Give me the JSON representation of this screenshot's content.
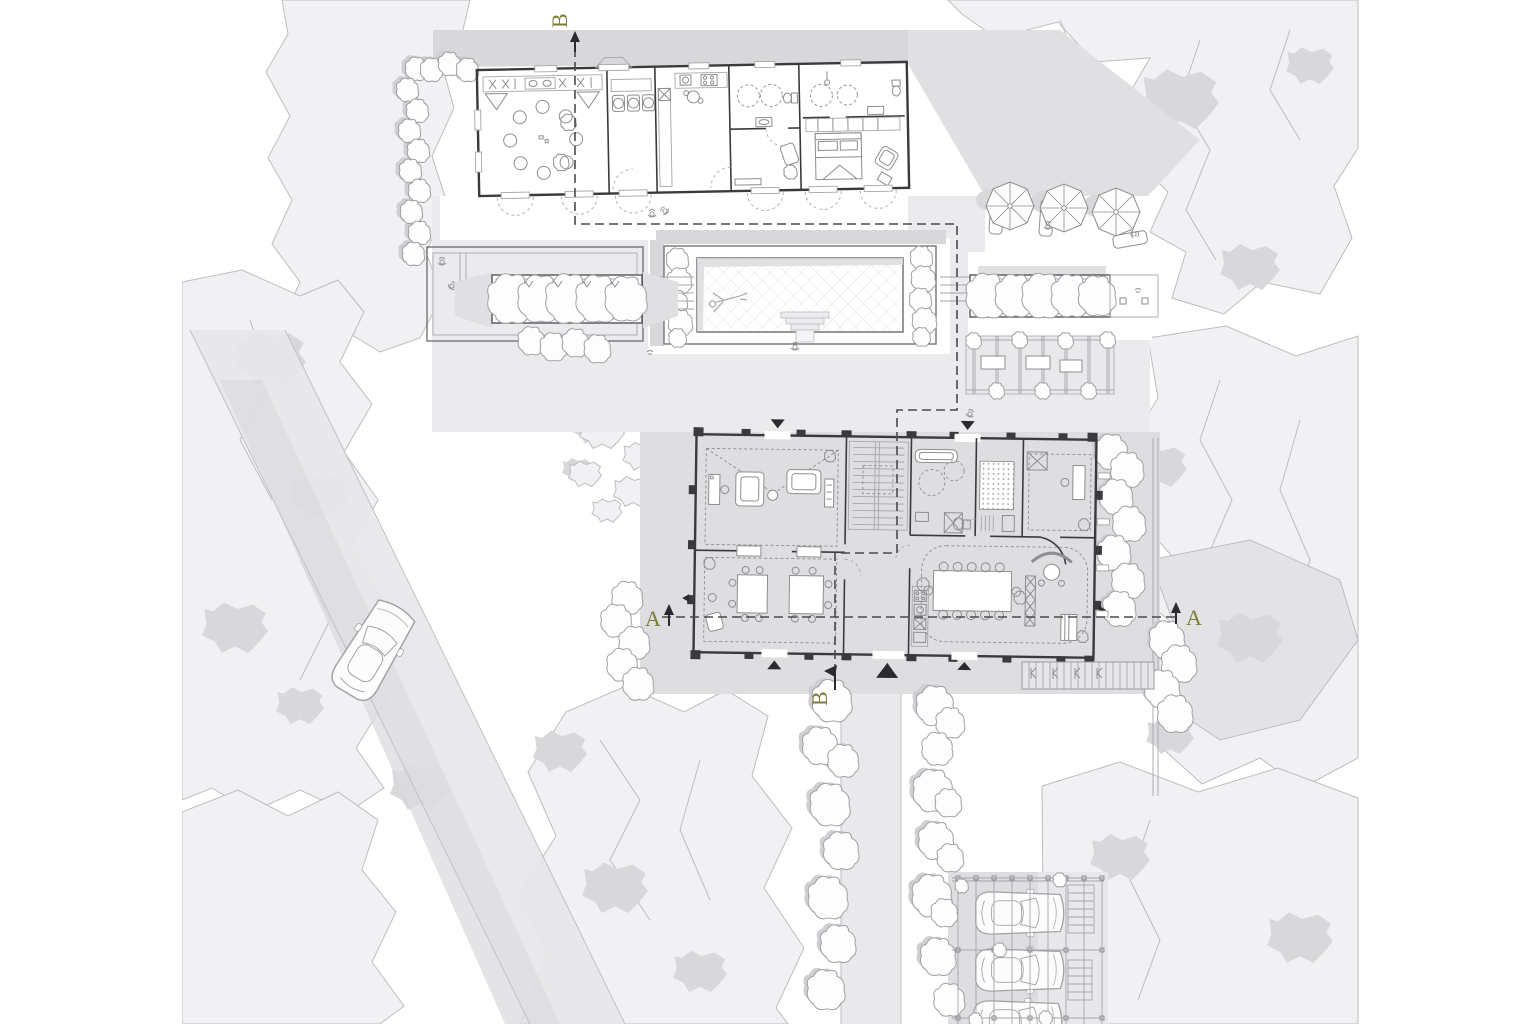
{
  "section_markers": {
    "b_top": "B",
    "b_bottom": "B",
    "a_left": "A",
    "a_right": "A"
  },
  "colors": {
    "accent": "#7c7c34",
    "wall": "#3a3a3e",
    "furniture": "#8e8e92",
    "thin": "#a6a6aa",
    "canopy_fill": "#f1f1f3",
    "canopy_stroke": "#bdbdc1",
    "shadow": "#d8d8db",
    "pad": "#ebebed",
    "terrace": "#dedee1",
    "section": "#4b4b4f",
    "paper": "#ffffff"
  }
}
